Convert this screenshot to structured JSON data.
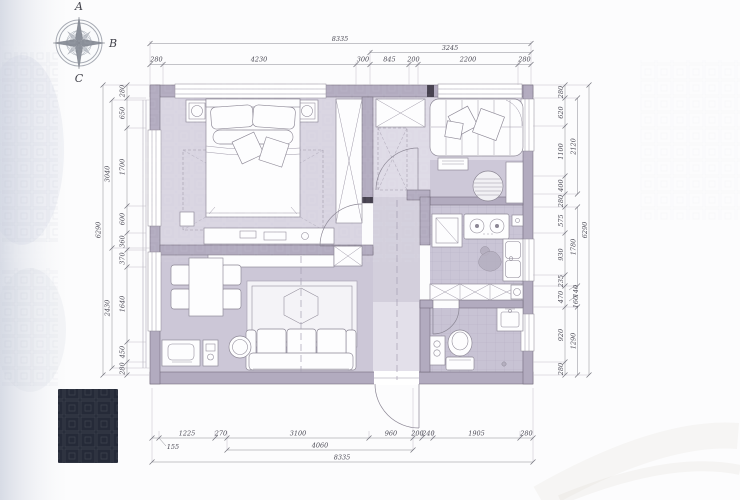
{
  "compass": {
    "top": "A",
    "right": "B",
    "bottom": "C"
  },
  "colors": {
    "wall": "#b2abbf",
    "floor": "#d2cdda",
    "floor_dark": "#c8c3d4",
    "accent_dark_block": "#252a38"
  },
  "dims": {
    "top": {
      "overall": "8335",
      "mid": "3245",
      "segs": [
        "280",
        "4230",
        "300",
        "845",
        "200",
        "2200",
        "280"
      ]
    },
    "bottom": {
      "overall": "8335",
      "mid": "4060",
      "leader": "155",
      "segs": [
        "1225",
        "270",
        "3100",
        "960",
        "200",
        "240",
        "1905",
        "280"
      ]
    },
    "left": {
      "overall": "6290",
      "mid": [
        "3040",
        "2430"
      ],
      "segs": [
        "280",
        "650",
        "1700",
        "600",
        "360",
        "370",
        "1640",
        "450",
        "280"
      ]
    },
    "right": {
      "overall": "6290",
      "mid": [
        "2120",
        "1780",
        "140",
        "160",
        "1290"
      ],
      "segs": [
        "280",
        "620",
        "1100",
        "400",
        "280",
        "575",
        "930",
        "235",
        "470",
        "920",
        "280"
      ]
    }
  }
}
